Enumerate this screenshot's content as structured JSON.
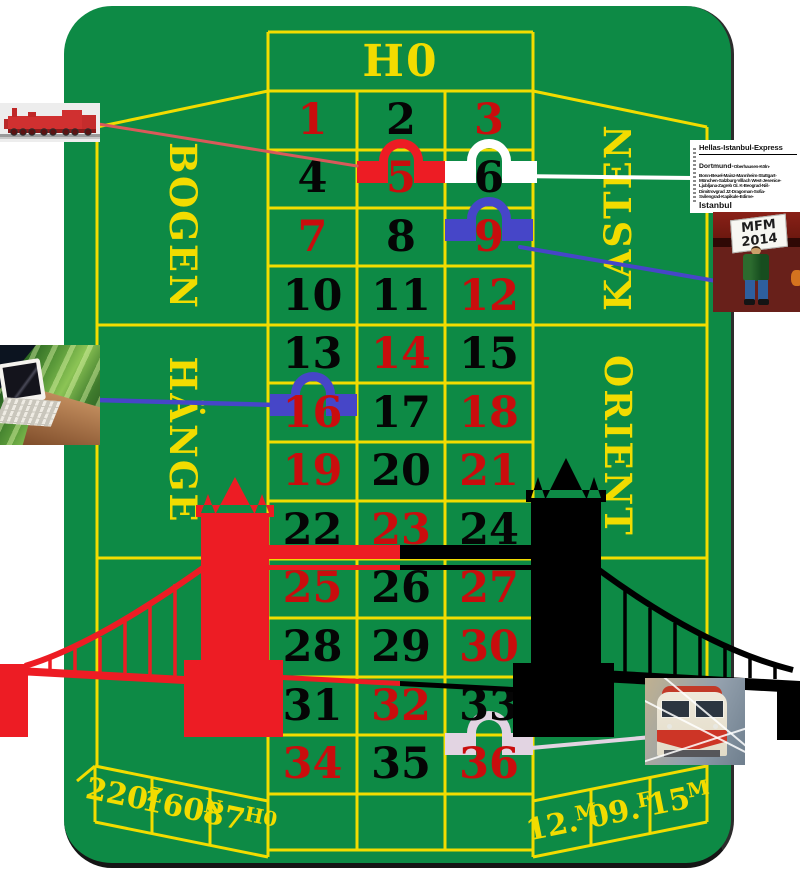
{
  "table": {
    "title": "H0",
    "felt_color": "#0D8A45",
    "line_color": "#F2DC00",
    "sections": {
      "top_left": "BOGEN",
      "top_right": "KASTEN",
      "mid_left": "HÄNGE",
      "mid_right": "ORIENT"
    },
    "numbers": [
      {
        "n": "1",
        "color": "red"
      },
      {
        "n": "2",
        "color": "black"
      },
      {
        "n": "3",
        "color": "red"
      },
      {
        "n": "4",
        "color": "black"
      },
      {
        "n": "5",
        "color": "red"
      },
      {
        "n": "6",
        "color": "black"
      },
      {
        "n": "7",
        "color": "red"
      },
      {
        "n": "8",
        "color": "black"
      },
      {
        "n": "9",
        "color": "red"
      },
      {
        "n": "10",
        "color": "black"
      },
      {
        "n": "11",
        "color": "black"
      },
      {
        "n": "12",
        "color": "red"
      },
      {
        "n": "13",
        "color": "black"
      },
      {
        "n": "14",
        "color": "red"
      },
      {
        "n": "15",
        "color": "black"
      },
      {
        "n": "16",
        "color": "red"
      },
      {
        "n": "17",
        "color": "black"
      },
      {
        "n": "18",
        "color": "red"
      },
      {
        "n": "19",
        "color": "red"
      },
      {
        "n": "20",
        "color": "black"
      },
      {
        "n": "21",
        "color": "red"
      },
      {
        "n": "22",
        "color": "black"
      },
      {
        "n": "23",
        "color": "red"
      },
      {
        "n": "24",
        "color": "black"
      },
      {
        "n": "25",
        "color": "red"
      },
      {
        "n": "26",
        "color": "black"
      },
      {
        "n": "27",
        "color": "red"
      },
      {
        "n": "28",
        "color": "black"
      },
      {
        "n": "29",
        "color": "black"
      },
      {
        "n": "30",
        "color": "red"
      },
      {
        "n": "31",
        "color": "black"
      },
      {
        "n": "32",
        "color": "red"
      },
      {
        "n": "33",
        "color": "black"
      },
      {
        "n": "34",
        "color": "red"
      },
      {
        "n": "35",
        "color": "black"
      },
      {
        "n": "36",
        "color": "red"
      }
    ],
    "markers": [
      {
        "number": "5",
        "color": "#ED1C24"
      },
      {
        "number": "6",
        "color": "#FFFFFF"
      },
      {
        "number": "9",
        "color": "#4646C8"
      },
      {
        "number": "16",
        "color": "#4646C8"
      },
      {
        "number": "36",
        "color": "#E2D4E2"
      }
    ],
    "bottom_left_boxes": [
      {
        "value": "220",
        "scale": "Z"
      },
      {
        "value": "160",
        "scale": "N"
      },
      {
        "value": "87",
        "scale": "H0"
      }
    ],
    "bottom_right_boxes": [
      {
        "value": "12.",
        "scale": "M"
      },
      {
        "value": "09.",
        "scale": "F"
      },
      {
        "value": "15",
        "scale": "M"
      }
    ]
  },
  "sign": {
    "title": "Hellas-Istanbul-Express",
    "origin": "Dortmund-",
    "route_lines": [
      "Oberhausen-Köln-",
      "Bonn-Beuel-Mainz-Mannheim-Stuttgart-",
      "München-Salzburg-Villach West-Jesenice-",
      "Ljubljana-Zagreb Gl. K-Beograd-Niš-",
      "Dimitrovgrad JZ-Dragoman-Sofia-",
      "Svilengrad-Kapikule-Edirne-"
    ],
    "destination": "Istanbul"
  },
  "mfm_photo": {
    "sign_line1": "MFM",
    "sign_line2": "2014"
  },
  "connectors": {
    "red": "#D95A5A",
    "white": "#FFFFFF",
    "blue": "#4646C8",
    "thistle": "#E2D4E2"
  },
  "bridge_colors": {
    "left": "#ED1C24",
    "right": "#000000"
  }
}
